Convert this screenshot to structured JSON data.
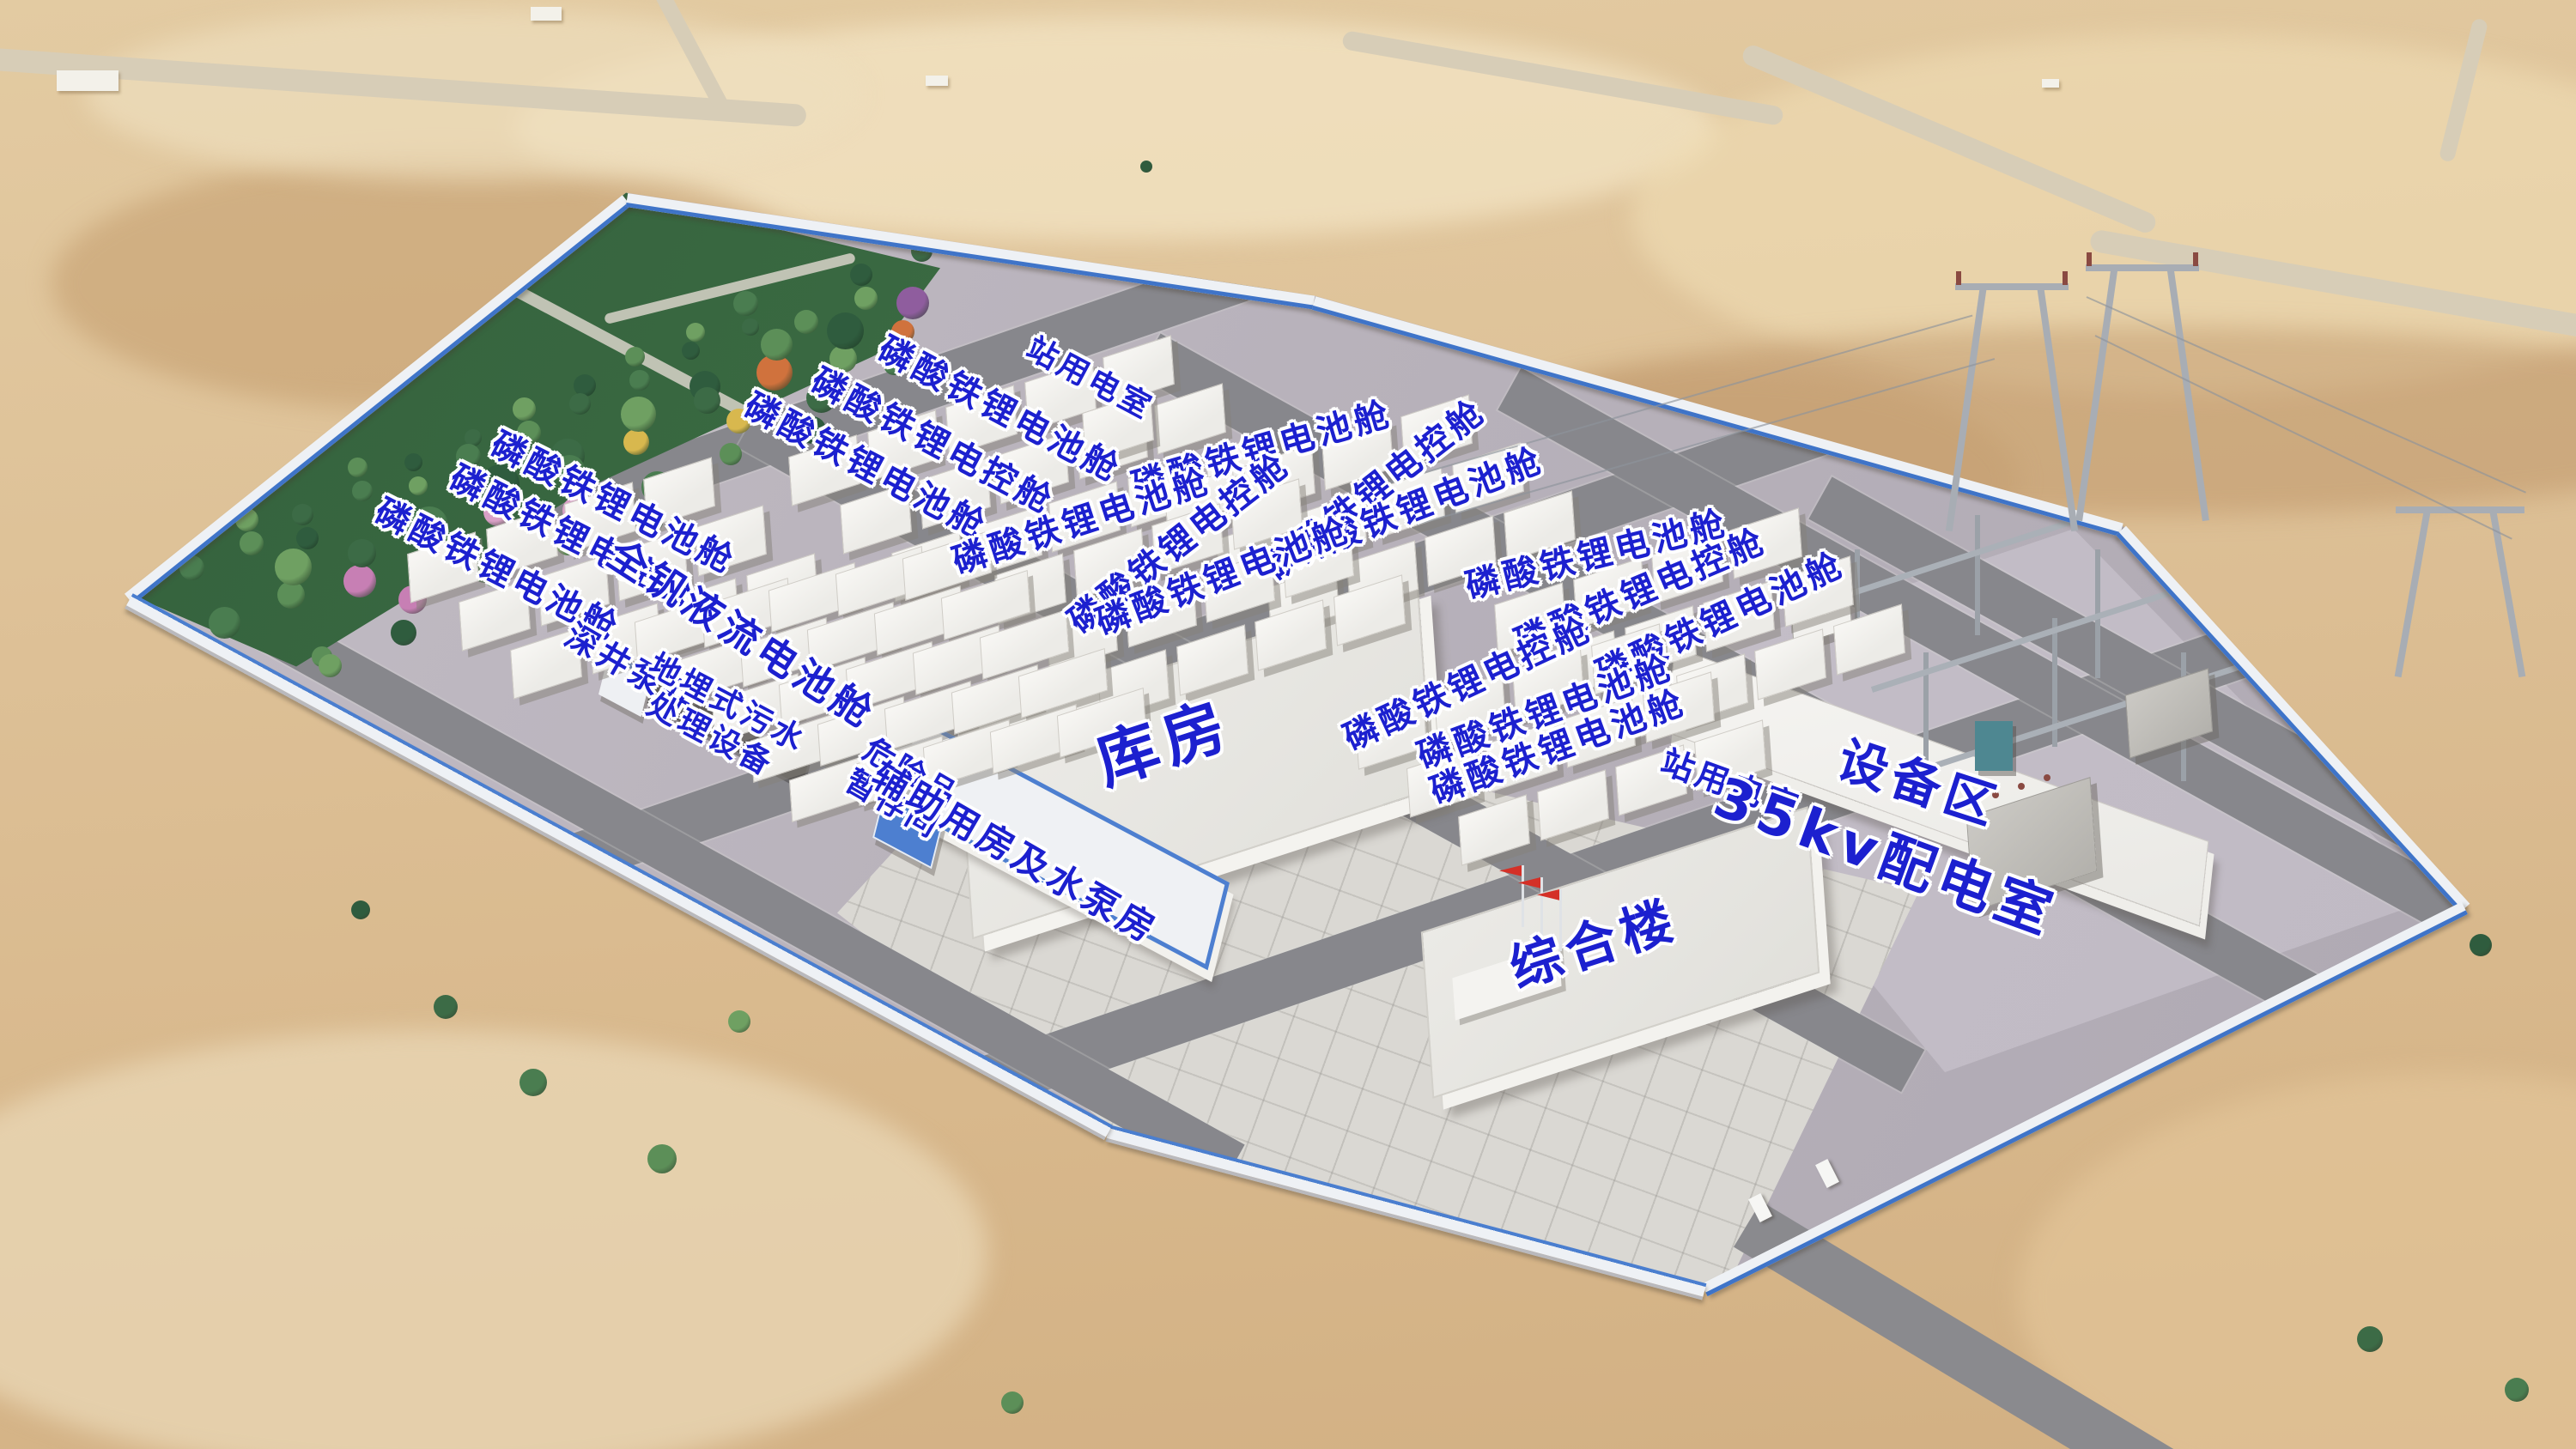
{
  "scene_title": "储能电站鸟瞰效果图",
  "colors": {
    "label_blue": "#1c20cf",
    "label_outline": "#ffffff",
    "desert_sand": "#dcbe92",
    "site_gravel": "#b6b0b9",
    "asphalt_road": "#87878c",
    "plaza_concrete": "#dad8d3",
    "container_white": "#f4f3f0",
    "fence_blue": "#3f74c8",
    "tree_green": "#3f6e48",
    "flag_red": "#d43027",
    "substation_pad": "#c1bbc5"
  },
  "labels": [
    {
      "id": "lfp-battery-label-1",
      "text": "磷酸铁锂电池舱",
      "x": 23.8,
      "y": 34.8,
      "rot": 27,
      "size": 40
    },
    {
      "id": "lfp-control-label-1",
      "text": "磷酸铁锂电控舱",
      "x": 22.2,
      "y": 37.1,
      "rot": 27,
      "size": 40
    },
    {
      "id": "lfp-battery-label-2",
      "text": "磷酸铁锂电池舱",
      "x": 19.3,
      "y": 39.4,
      "rot": 27,
      "size": 40
    },
    {
      "id": "lfp-battery-label-3",
      "text": "磷酸铁锂电池舱",
      "x": 38.8,
      "y": 28.3,
      "rot": 28,
      "size": 40
    },
    {
      "id": "lfp-control-label-2",
      "text": "磷酸铁锂电控舱",
      "x": 36.2,
      "y": 30.5,
      "rot": 28,
      "size": 40
    },
    {
      "id": "lfp-battery-label-4",
      "text": "磷酸铁锂电池舱",
      "x": 33.6,
      "y": 32.2,
      "rot": 28,
      "size": 40
    },
    {
      "id": "station-power-label-1",
      "text": "站用电室",
      "x": 42.3,
      "y": 26.2,
      "rot": 28,
      "size": 36
    },
    {
      "id": "lfp-battery-label-5",
      "text": "磷酸铁锂电池舱",
      "x": 49.0,
      "y": 31.1,
      "rot": -16,
      "size": 40
    },
    {
      "id": "lfp-control-label-3",
      "text": "磷酸铁锂电控舱",
      "x": 53.4,
      "y": 33.8,
      "rot": -38,
      "size": 40
    },
    {
      "id": "lfp-battery-label-6",
      "text": "磷酸铁锂电池舱",
      "x": 55.0,
      "y": 35.0,
      "rot": -21,
      "size": 40
    },
    {
      "id": "lfp-battery-label-7",
      "text": "磷酸铁锂电池舱",
      "x": 42.0,
      "y": 36.0,
      "rot": -18,
      "size": 40
    },
    {
      "id": "lfp-control-label-4",
      "text": "磷酸铁锂电控舱",
      "x": 45.8,
      "y": 37.5,
      "rot": -38,
      "size": 40
    },
    {
      "id": "lfp-battery-label-8",
      "text": "磷酸铁锂电池舱",
      "x": 47.5,
      "y": 39.8,
      "rot": -21,
      "size": 40
    },
    {
      "id": "lfp-battery-label-9",
      "text": "磷酸铁锂电池舱",
      "x": 62.0,
      "y": 38.3,
      "rot": -14,
      "size": 40
    },
    {
      "id": "lfp-control-label-5",
      "text": "磷酸铁锂电控舱",
      "x": 63.7,
      "y": 40.9,
      "rot": -23,
      "size": 40
    },
    {
      "id": "lfp-battery-label-10",
      "text": "磷酸铁锂电池舱",
      "x": 66.8,
      "y": 42.8,
      "rot": -25,
      "size": 40
    },
    {
      "id": "lfp-control-label-6",
      "text": "磷酸铁锂电控舱",
      "x": 57.0,
      "y": 47.2,
      "rot": -25,
      "size": 40
    },
    {
      "id": "lfp-battery-label-11",
      "text": "磷酸铁锂电池舱",
      "x": 60.0,
      "y": 49.2,
      "rot": -20,
      "size": 40
    },
    {
      "id": "lfp-battery-label-12",
      "text": "磷酸铁锂电池舱",
      "x": 60.5,
      "y": 51.6,
      "rot": -20,
      "size": 40
    },
    {
      "id": "vanadium-flow-label",
      "text": "全钒液流电池舱",
      "x": 28.8,
      "y": 43.8,
      "rot": 33,
      "size": 46
    },
    {
      "id": "deep-well-pump-label",
      "text": "深井泵井",
      "x": 24.5,
      "y": 46.2,
      "rot": 30,
      "size": 38
    },
    {
      "id": "sewage-treatment-label",
      "text": "地埋式污水\n处理设备",
      "x": 27.9,
      "y": 49.7,
      "rot": 28,
      "size": 36
    },
    {
      "id": "hazmat-storage-label",
      "text": "危险品\n暂存间",
      "x": 35.0,
      "y": 54.5,
      "rot": 30,
      "size": 36
    },
    {
      "id": "auxiliary-pump-house-label",
      "text": "辅助用房及水泵房",
      "x": 39.4,
      "y": 58.9,
      "rot": 30,
      "size": 42
    },
    {
      "id": "warehouse-label",
      "text": "库房",
      "x": 45.2,
      "y": 51.3,
      "rot": -18,
      "size": 72
    },
    {
      "id": "complex-building-label",
      "text": "综合楼",
      "x": 61.9,
      "y": 65.2,
      "rot": -18,
      "size": 60
    },
    {
      "id": "station-power-label-2",
      "text": "站用电室",
      "x": 67.2,
      "y": 54.2,
      "rot": 20,
      "size": 38
    },
    {
      "id": "distribution-35kv-label",
      "text": "35kv配电室",
      "x": 73.2,
      "y": 59.2,
      "rot": 20,
      "size": 64
    },
    {
      "id": "equipment-area-label",
      "text": "设备区",
      "x": 74.5,
      "y": 54.1,
      "rot": 18,
      "size": 58
    }
  ],
  "layout": {
    "clusters": [
      {
        "name": "lfp-cluster-a",
        "o": [
          15.8,
          37.5
        ],
        "per": 4,
        "lines": 3,
        "type": "std"
      },
      {
        "name": "lfp-cluster-b",
        "o": [
          30.6,
          30.8
        ],
        "per": 5,
        "lines": 3,
        "type": "std"
      },
      {
        "name": "station-power-box",
        "o": [
          42.0,
          27.8
        ],
        "per": 1,
        "lines": 1,
        "type": "std"
      },
      {
        "name": "lfp-cluster-c",
        "o": [
          45.2,
          33.2
        ],
        "per": 4,
        "lines": 3,
        "type": "std"
      },
      {
        "name": "lfp-cluster-d",
        "o": [
          38.6,
          39.0
        ],
        "per": 4,
        "lines": 3,
        "type": "std"
      },
      {
        "name": "lfp-cluster-f",
        "o": [
          58.0,
          41.0
        ],
        "per": 4,
        "lines": 3,
        "type": "std"
      },
      {
        "name": "lfp-cluster-g",
        "o": [
          52.6,
          49.0
        ],
        "per": 4,
        "lines": 3,
        "type": "std"
      },
      {
        "name": "vanadium-cluster",
        "o": [
          24.6,
          42.0
        ],
        "per": 5,
        "lines": 5,
        "type": "wide"
      }
    ],
    "steps": {
      "std": {
        "ax": [
          3.05,
          -1.72
        ],
        "bx": [
          2.0,
          3.32
        ]
      },
      "wide": {
        "ax": [
          2.6,
          -1.1
        ],
        "bx": [
          1.5,
          2.72
        ]
      }
    },
    "tree_bands": [
      {
        "p1": [
          6.3,
          39.3
        ],
        "p2": [
          34.7,
          18.4
        ],
        "n": 26,
        "rmin": 20,
        "rmax": 30,
        "flowers": false
      },
      {
        "p1": [
          8.7,
          42.7
        ],
        "p2": [
          35.3,
          21.3
        ],
        "n": 20,
        "rmin": 30,
        "rmax": 46,
        "flowers": true
      },
      {
        "p1": [
          11.3,
          46.2
        ],
        "p2": [
          36.0,
          24.2
        ],
        "n": 16,
        "rmin": 24,
        "rmax": 38,
        "flowers": true
      }
    ],
    "outside_trees": [
      [
        17.3,
        69.5,
        28
      ],
      [
        20.7,
        74.7,
        32
      ],
      [
        25.7,
        80.0,
        34
      ],
      [
        28.7,
        70.5,
        26
      ],
      [
        14.0,
        62.8,
        22
      ],
      [
        68.3,
        33.9,
        26
      ],
      [
        67.0,
        35.5,
        22
      ],
      [
        91.3,
        57.0,
        24
      ],
      [
        94.3,
        60.7,
        28
      ],
      [
        96.3,
        65.2,
        26
      ],
      [
        92.0,
        92.4,
        30
      ],
      [
        97.7,
        95.9,
        28
      ],
      [
        39.3,
        96.8,
        26
      ],
      [
        31.0,
        16.0,
        16
      ],
      [
        44.5,
        11.5,
        14
      ]
    ],
    "tree_palette": [
      "#3c6b46",
      "#4a7d50",
      "#5c8f58",
      "#6fa062",
      "#2f5c3e"
    ],
    "flower_palette": [
      "#c77fb4",
      "#d9a0c6",
      "#d8b84e",
      "#d0723d",
      "#8f5d9e"
    ]
  }
}
